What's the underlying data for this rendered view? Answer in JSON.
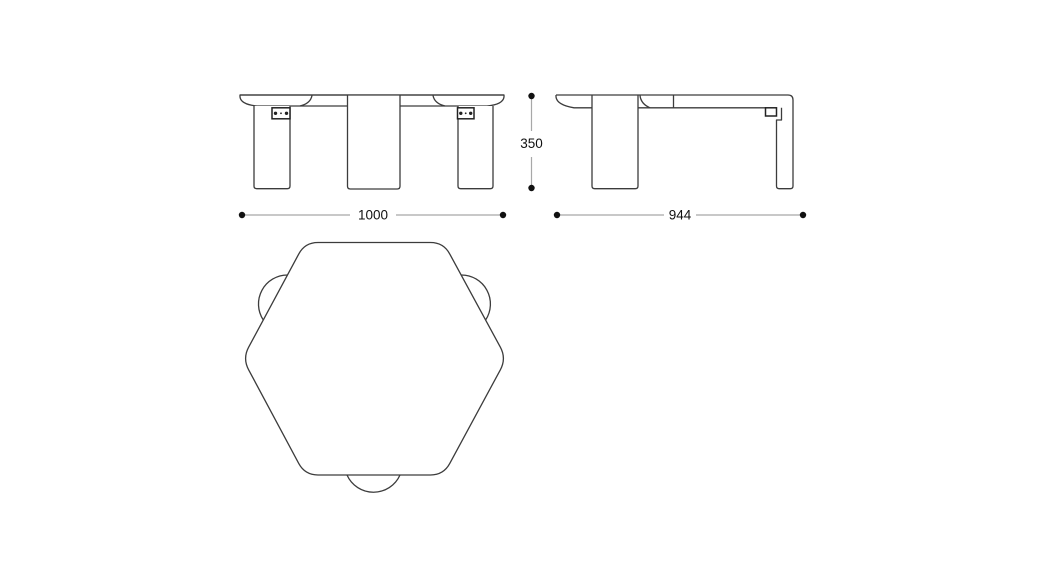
{
  "drawing": {
    "dimensions": {
      "front_width": "1000",
      "side_depth": "944",
      "height": "350"
    },
    "colors": {
      "background": "#ffffff",
      "object_line": "#3c3c3c",
      "bracket_line": "#222222",
      "dimension_line": "#a8a8a8",
      "dimension_text": "#111111"
    }
  }
}
